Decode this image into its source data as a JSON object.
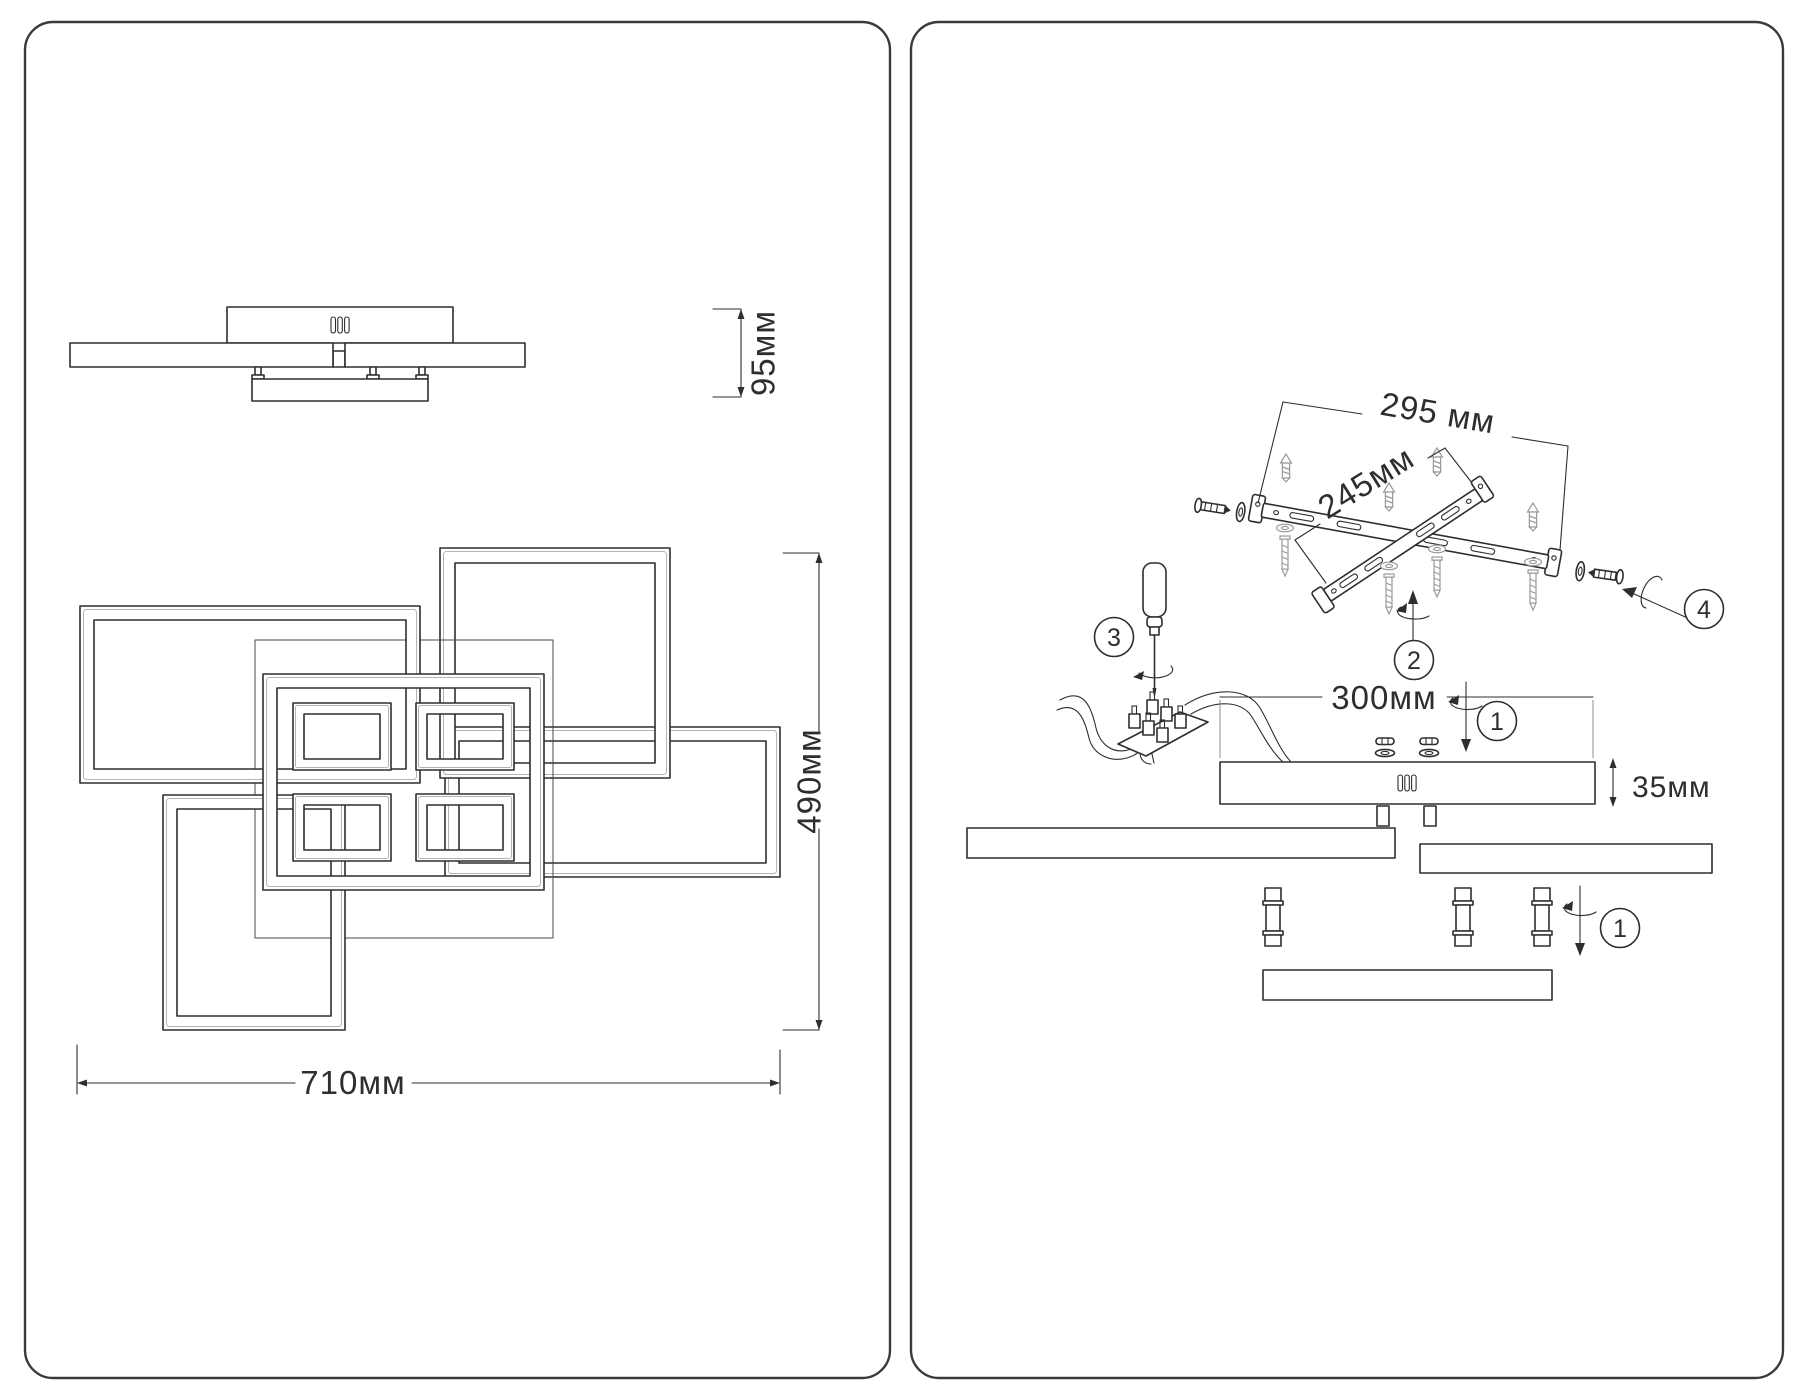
{
  "doc": {
    "kind": "ceiling-light technical drawing and assembly instruction",
    "background": "#ffffff",
    "line_color": "#2e2e2e",
    "panel_border_color": "#3a3a3a",
    "soft_line_color": "#9a9a9a"
  },
  "dims": {
    "h95": "95мм",
    "w710": "710мм",
    "d490": "490мм",
    "b295": "295 мм",
    "b245": "245мм",
    "c300": "300мм",
    "c35": "35мм"
  },
  "steps": {
    "one": "1",
    "two": "2",
    "three": "3",
    "four": "4"
  }
}
